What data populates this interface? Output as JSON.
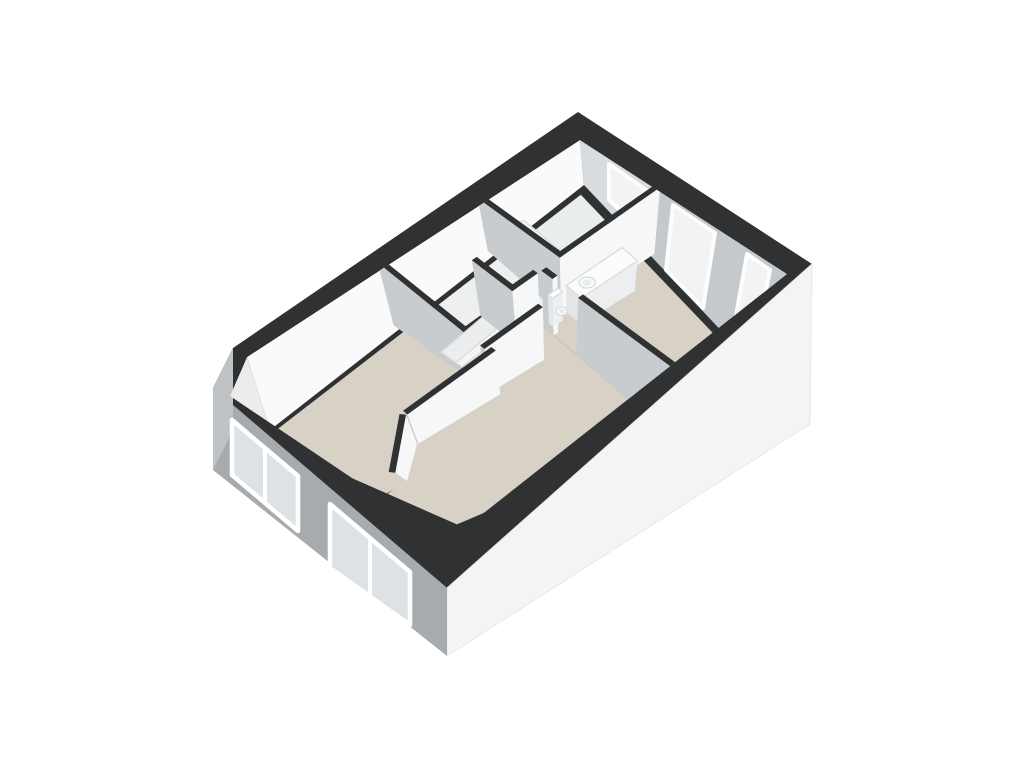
{
  "meta": {
    "kind": "3d-floor-plan-rendering",
    "background": "#ffffff",
    "view": "axonometric-from-south"
  },
  "palette": {
    "band": "#2f3133",
    "floor_beige": "#d8d1c6",
    "floor_white": "#eef0f0",
    "floor_bath": "#eaeded",
    "nw_face": "#fafafa",
    "ne_face": "#d9dcde",
    "ne_face_dark": "#c6c9cb",
    "chamfer_face": "#ececec",
    "wall_lit": "#f6f7f8",
    "wall_shade": "#c9cccf",
    "facade_sw": "#a8abad",
    "facade_se": "#f4f4f4",
    "facade_chamfer": "#bfc2c4",
    "facade_glass": "#dfe2e4",
    "frame": "#ffffff",
    "win_glass": "#f1f3f4",
    "win_frame": "#fdfdfd",
    "tub": "#f3f5f6",
    "tub_inner": "#e9eced",
    "tub_stroke": "#dcdedf",
    "glass_screen": "#474b50",
    "fixture_white": "#fbfcfc",
    "fixture_front": "#eceeef",
    "fixture_side": "#e3e5e6",
    "fixture_stroke": "#d9dbdd",
    "step_a": "#f4f5f5",
    "step_b": "#ecedee",
    "step_stroke": "#d8dadb"
  },
  "projection": {
    "plan_w": 960,
    "plan_h": 640,
    "top": [
      [
        247,
        357
      ],
      [
        580,
        140
      ],
      [
        787,
        274
      ],
      [
        447,
        542
      ]
    ],
    "floor": [
      [
        270,
        430
      ],
      [
        584,
        185
      ],
      [
        765,
        377
      ],
      [
        455,
        515
      ]
    ]
  },
  "band_outer": [
    [
      578,
      112
    ],
    [
      812,
      264
    ],
    [
      447,
      588
    ],
    [
      213,
      388
    ],
    [
      233,
      348
    ]
  ],
  "clip_polygon": [
    [
      580,
      140
    ],
    [
      787,
      274
    ],
    [
      447,
      542
    ],
    [
      230,
      396
    ],
    [
      247,
      357
    ]
  ],
  "facades": {
    "se": {
      "name": "facade-se",
      "poly": [
        [
          812,
          264
        ],
        [
          447,
          588
        ],
        [
          447,
          656
        ],
        [
          810,
          424
        ]
      ],
      "fill": "facade_se"
    },
    "sw": {
      "name": "facade-sw",
      "poly": [
        [
          213,
          388
        ],
        [
          447,
          588
        ],
        [
          447,
          656
        ],
        [
          213,
          470
        ]
      ],
      "fill": "facade_sw"
    },
    "chamfer": {
      "name": "facade-chamfer",
      "poly": [
        [
          233,
          348
        ],
        [
          213,
          388
        ],
        [
          213,
          470
        ],
        [
          233,
          430
        ]
      ],
      "fill": "facade_chamfer"
    },
    "sw_windows": [
      {
        "name": "window-bedroom-left",
        "quad": [
          [
            232,
            420
          ],
          [
            298,
            476
          ],
          [
            298,
            531
          ],
          [
            232,
            475
          ]
        ],
        "mullion": [
          [
            265,
            448
          ],
          [
            265,
            503
          ]
        ]
      },
      {
        "name": "window-living-room",
        "quad": [
          [
            330,
            504
          ],
          [
            410,
            572
          ],
          [
            410,
            625
          ],
          [
            330,
            568
          ]
        ],
        "mullion": [
          [
            370,
            538
          ],
          [
            370,
            597
          ]
        ]
      }
    ]
  },
  "wall_faces": [
    {
      "name": "wall-face-nw-interior",
      "quad": [
        [
          247,
          357
        ],
        [
          580,
          140
        ],
        [
          584,
          185
        ],
        [
          270,
          430
        ]
      ],
      "fill": "nw_face"
    },
    {
      "name": "wall-face-ne-interior",
      "quad": [
        [
          580,
          140
        ],
        [
          787,
          274
        ],
        [
          765,
          377
        ],
        [
          584,
          185
        ]
      ],
      "fill": "ne_face"
    },
    {
      "name": "wall-face-ne-bedroom",
      "quad": [
        [
          654,
          188
        ],
        [
          787,
          274
        ],
        [
          765,
          377
        ],
        [
          649,
          254
        ]
      ],
      "fill": "ne_face_dark"
    },
    {
      "name": "wall-face-chamfer-interior",
      "quad": [
        [
          247,
          357
        ],
        [
          230,
          396
        ],
        [
          250,
          440
        ],
        [
          270,
          430
        ]
      ],
      "fill": "chamfer_face"
    }
  ],
  "ne_windows": [
    {
      "name": "window-bathroom",
      "quad": [
        [
          609,
          164
        ],
        [
          649,
          192
        ],
        [
          646,
          235
        ],
        [
          609,
          200
        ]
      ]
    },
    {
      "name": "window-bedroom-right-a",
      "quad": [
        [
          673,
          205
        ],
        [
          715,
          233
        ],
        [
          703,
          308
        ],
        [
          666,
          270
        ]
      ]
    },
    {
      "name": "window-bedroom-right-b",
      "quad": [
        [
          747,
          254
        ],
        [
          770,
          270
        ],
        [
          752,
          359
        ],
        [
          732,
          338
        ]
      ]
    }
  ],
  "floors": [
    {
      "name": "floor-bedroom-left",
      "poly": [
        [
          14,
          14
        ],
        [
          409,
          14
        ],
        [
          409,
          337
        ],
        [
          157,
          337
        ],
        [
          37,
          437
        ],
        [
          -30,
          437
        ],
        [
          -30,
          14
        ]
      ],
      "fill": "floor_beige"
    },
    {
      "name": "floor-living-room",
      "poly": [
        [
          150,
          337
        ],
        [
          409,
          337
        ],
        [
          409,
          317
        ],
        [
          554,
          317
        ],
        [
          554,
          237
        ],
        [
          630,
          237
        ],
        [
          630,
          680
        ],
        [
          -30,
          680
        ],
        [
          -30,
          440
        ],
        [
          30,
          430
        ]
      ],
      "fill": "floor_beige"
    },
    {
      "name": "floor-bedroom-right",
      "poly": [
        [
          630,
          237
        ],
        [
          938,
          237
        ],
        [
          938,
          680
        ],
        [
          630,
          680
        ]
      ],
      "fill": "floor_beige"
    },
    {
      "name": "floor-hall",
      "poly": [
        [
          395,
          14
        ],
        [
          690,
          14
        ],
        [
          690,
          237
        ],
        [
          547,
          237
        ],
        [
          547,
          110
        ],
        [
          395,
          110
        ]
      ],
      "fill": "floor_white"
    },
    {
      "name": "floor-bathroom",
      "poly": [
        [
          683,
          14
        ],
        [
          938,
          14
        ],
        [
          938,
          230
        ],
        [
          683,
          230
        ]
      ],
      "fill": "floor_bath"
    }
  ],
  "items": [
    {
      "name": "staircase",
      "type": "steps",
      "key": 209,
      "quads": [
        [
          [
            409,
            182
          ],
          [
            547,
            168
          ],
          [
            547,
            117
          ],
          [
            409,
            130
          ]
        ],
        [
          [
            409,
            203
          ],
          [
            547,
            192
          ],
          [
            547,
            168
          ],
          [
            409,
            182
          ]
        ],
        [
          [
            409,
            222
          ],
          [
            547,
            216
          ],
          [
            547,
            192
          ],
          [
            409,
            203
          ]
        ],
        [
          [
            409,
            240
          ],
          [
            547,
            240
          ],
          [
            547,
            216
          ],
          [
            409,
            222
          ]
        ],
        [
          [
            409,
            240
          ],
          [
            547,
            240
          ],
          [
            547,
            261
          ],
          [
            409,
            261
          ]
        ],
        [
          [
            409,
            261
          ],
          [
            547,
            261
          ],
          [
            547,
            282
          ],
          [
            409,
            282
          ]
        ],
        [
          [
            409,
            282
          ],
          [
            547,
            282
          ],
          [
            547,
            303
          ],
          [
            409,
            303
          ]
        ]
      ]
    },
    {
      "name": "bathtub",
      "type": "tub",
      "key": 123,
      "rect": [
        697,
        28,
        760,
        218
      ]
    },
    {
      "name": "shower-glass-screen",
      "type": "glass",
      "key": 124,
      "edge": [
        697,
        218,
        760,
        218
      ]
    },
    {
      "name": "wall-bathroom-west",
      "type": "wall",
      "key": 126,
      "line": [
        690,
        -20,
        690,
        237
      ],
      "cap": true
    },
    {
      "name": "wall-bedroom-left-east",
      "type": "wall",
      "key": 150,
      "line": [
        402,
        -20,
        402,
        317
      ],
      "cap": true
    },
    {
      "name": "wall-stair-east",
      "type": "wall",
      "key": 214,
      "line": [
        554,
        110,
        554,
        317
      ],
      "cap": true
    },
    {
      "name": "wall-hall-south",
      "type": "wall",
      "key": 231,
      "line": [
        547,
        230,
        620,
        230
      ],
      "cap": true
    },
    {
      "name": "wall-bathroom-south",
      "type": "wall",
      "key": 232,
      "line": [
        683,
        230,
        970,
        230
      ],
      "cap": true
    },
    {
      "name": "wall-bedroom-right-west-upper",
      "type": "wall",
      "key": 254,
      "line": [
        637,
        237,
        637,
        272
      ],
      "cap": true
    },
    {
      "name": "toilet-cistern",
      "type": "box",
      "key": 260,
      "rect": [
        646,
        237,
        676,
        252
      ],
      "k": 0.5
    },
    {
      "name": "vanity-cabinet",
      "type": "box",
      "key": 262,
      "rect": [
        700,
        237,
        866,
        288
      ],
      "k": 0.55
    },
    {
      "name": "sink-basin",
      "type": "ellipse",
      "key": 263,
      "c": [
        740,
        262
      ],
      "r": [
        20,
        14
      ],
      "k": 0.55,
      "inner": true
    },
    {
      "name": "toilet-bowl",
      "type": "ellipse",
      "key": 264,
      "c": [
        661,
        266
      ],
      "r": [
        14,
        11
      ],
      "k": 0.72,
      "inner": true
    },
    {
      "name": "wall-stair-south",
      "type": "wall",
      "key": 311,
      "line": [
        395,
        310,
        561,
        310
      ],
      "cap": true
    },
    {
      "name": "wall-bedroom-left-south",
      "type": "wall",
      "key": 331,
      "line": [
        157,
        330,
        409,
        330
      ],
      "cap": true
    },
    {
      "name": "wall-bedroom-left-diagonal",
      "type": "wall",
      "key": 380,
      "line": [
        150,
        330,
        32,
        428
      ],
      "cap": false
    },
    {
      "name": "wall-bedroom-right-west-lower",
      "type": "wall",
      "key": 516,
      "line": [
        637,
        352,
        637,
        680
      ],
      "cap": false
    }
  ]
}
